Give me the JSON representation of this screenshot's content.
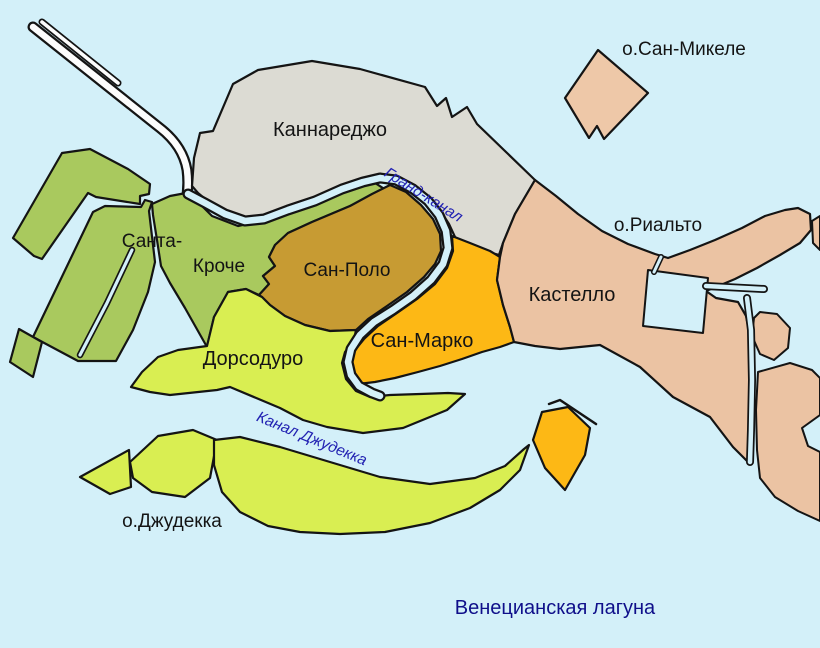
{
  "map": {
    "background_color": "#d3f0f9",
    "outline_color": "#141414",
    "causeway_color": "#fcfcfc",
    "regions": {
      "cannaregio": {
        "label": "Каннареджо",
        "color": "#dcdbd3"
      },
      "santa_croce": {
        "label_line1": "Санта-",
        "label_line2": "Кроче",
        "color": "#a9c95e"
      },
      "san_polo": {
        "label": "Сан-Поло",
        "color": "#c79b33"
      },
      "san_marco": {
        "label": "Сан-Марко",
        "color": "#fdb815"
      },
      "dorsoduro": {
        "label": "Дорсодуро",
        "color": "#d9ee52"
      },
      "castello": {
        "label": "Кастелло",
        "color": "#ebc3a3"
      }
    },
    "islands": {
      "san_michele": {
        "label": "о.Сан-Микеле",
        "color": "#eec8a8"
      },
      "rialto": {
        "label": "о.Риальто"
      },
      "giudecca": {
        "label": "о.Джудекка",
        "color": "#d9ee52"
      },
      "san_giorgio": {
        "color": "#fdb815"
      }
    },
    "waterways": {
      "grand_canal": {
        "label": "Гранд-канал",
        "label_color": "#2222b2"
      },
      "giudecca_canal": {
        "label": "Канал Джудекка",
        "label_color": "#2222b2"
      },
      "lagoon": {
        "label": "Венецианская лагуна",
        "label_color": "#0f0f8a"
      }
    }
  }
}
